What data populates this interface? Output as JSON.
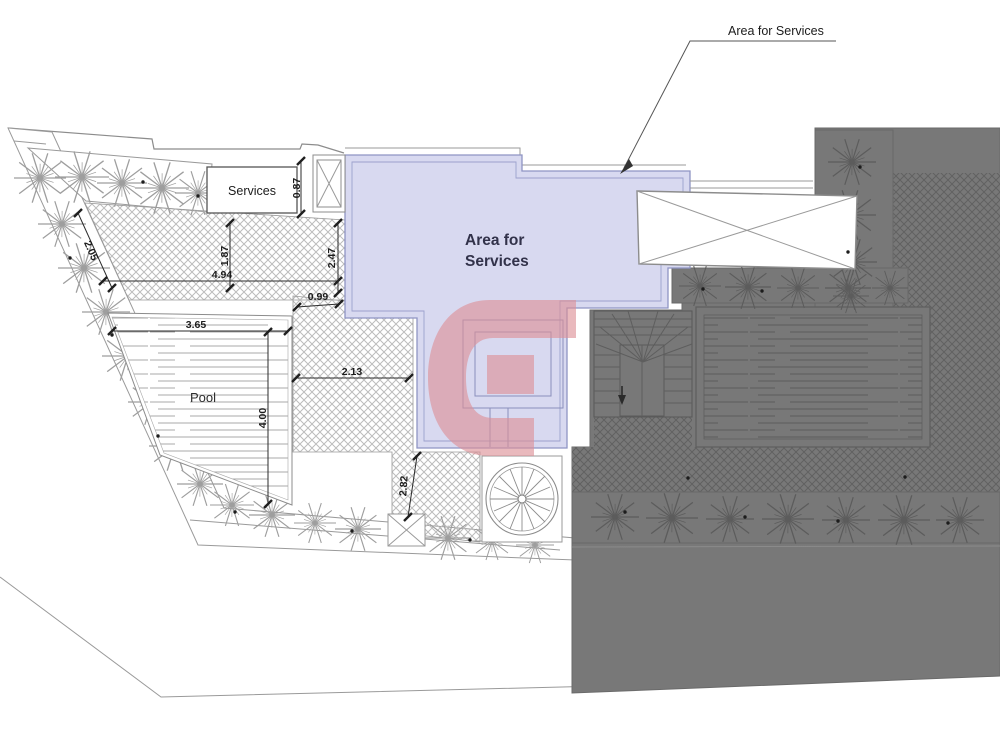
{
  "annotation": {
    "label": "Area for Services"
  },
  "labels": {
    "services_room": "Services",
    "pool": "Pool",
    "area_line1": "Area for",
    "area_line2": "Services"
  },
  "dimensions": [
    {
      "name": "services-right-gap",
      "value": "0.87"
    },
    {
      "name": "upper-terrace-slant",
      "value": "2.05"
    },
    {
      "name": "terrace-height-left",
      "value": "1.87"
    },
    {
      "name": "terrace-width",
      "value": "4.94"
    },
    {
      "name": "terrace-height-right",
      "value": "2.47"
    },
    {
      "name": "neck-width",
      "value": "0.99"
    },
    {
      "name": "pool-width",
      "value": "3.65"
    },
    {
      "name": "walk-width",
      "value": "2.13"
    },
    {
      "name": "pool-length",
      "value": "4.00"
    },
    {
      "name": "lower-walk-length",
      "value": "2.82"
    }
  ],
  "colors": {
    "area_fill": "#d8d9f0",
    "area_border": "#8f94c4",
    "dark_building": "#787878",
    "dark_hatch_line": "#616161",
    "light_hatch_line": "#bcbcbc",
    "watermark_pink": "#dd8f96",
    "drawing_line": "#8c8c8c",
    "dimension_ink": "#1c1c1c"
  }
}
